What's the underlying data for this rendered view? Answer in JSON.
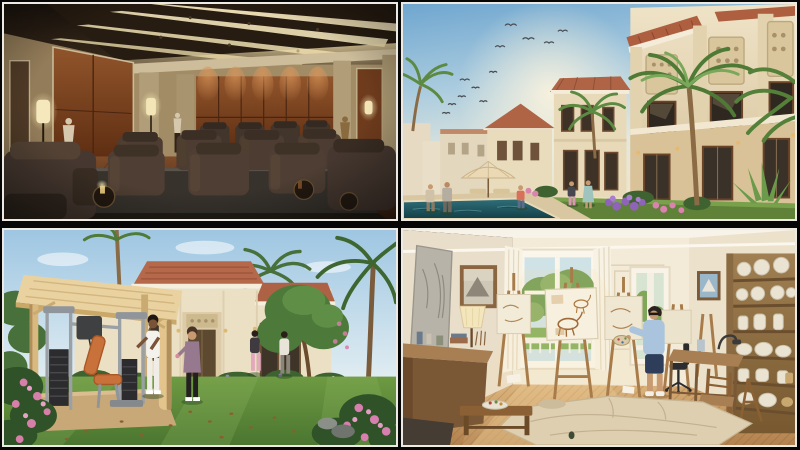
{
  "page": {
    "title": "Residential amenity renderings collage",
    "background_color": "#060606",
    "frame_color": "#eceae3",
    "grid": {
      "rows": 2,
      "cols": 2
    }
  },
  "panels": [
    {
      "id": "home-theater",
      "position": "top-left",
      "label": "Private home theater rendering",
      "description": "Dim luxury cinema room with coffered ceiling light slots, copper wall panels, statues on pedestals, glowing lamps and rows of dark leather recliners on a platform over a wood floor.",
      "palette": {
        "ceiling": "#2a1f15",
        "light_strips": "#f2e4ba",
        "copper_wall": "#7c4522",
        "trim": "#b3a07c",
        "seats": "#4a3a30",
        "floor": "#6b4226"
      }
    },
    {
      "id": "villas-exterior",
      "position": "top-right",
      "label": "Mediterranean villas courtyard rendering",
      "description": "Cream two-storey villas with terracotta roofs and carved panels receding along a lawn with palms, flower beds, strolling residents, a patio umbrella and a teal pool under a blue sky with birds.",
      "palette": {
        "sky": "#6fa6cf",
        "walls": "#eee2c6",
        "roofs": "#ad5f40",
        "palms": "#5d8a42",
        "pool": "#2e6d74",
        "lawn": "#5f8238"
      }
    },
    {
      "id": "garden-gym",
      "position": "bottom-left",
      "label": "Outdoor garden gym rendering",
      "description": "Timber pergola sheltering grey gym machines with orange pads on a lawn before a cream villa with terracotta hip roofs; two women exercise while residents stroll among palms and pink flowers.",
      "palette": {
        "sky": "#9ec6e2",
        "pergola": "#ead2a0",
        "equipment": "#9aa0a4",
        "bench": "#c9713a",
        "lawn": "#6a9440",
        "roof": "#b5684a"
      }
    },
    {
      "id": "art-studio",
      "position": "bottom-right",
      "label": "Sunlit art studio rendering",
      "description": "Warm cream studio with wooden easels and sketch canvases, a man in a blue top and navy shorts painting, a garden seen through tall french windows, shelves of white pottery, wooden tables and a drop cloth on parquet flooring.",
      "palette": {
        "walls": "#f0e8d6",
        "wood": "#a87c4a",
        "canvas": "#f7f0de",
        "shirt": "#a9c4dc",
        "floor": "#d3a873",
        "garden": "#6f9a50"
      }
    }
  ]
}
